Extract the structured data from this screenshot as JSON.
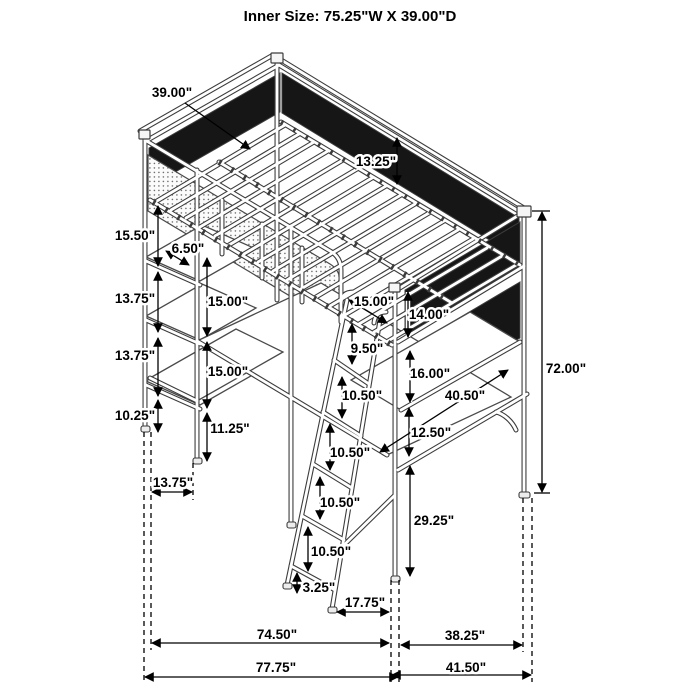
{
  "title": "Inner Size: 75.25\"W X 39.00\"D",
  "diagram_type": "isometric loft-bed dimension drawing",
  "colors": {
    "line": "#3c3c3c",
    "mesh": "#161616",
    "dimension": "#000000",
    "background": "#ffffff"
  },
  "dims": [
    {
      "id": "top-depth",
      "label": "39.00\""
    },
    {
      "id": "guard-rail-height",
      "label": "13.25\""
    },
    {
      "id": "shelf-gap-1",
      "label": "15.50\""
    },
    {
      "id": "shelf-setback",
      "label": "6.50\""
    },
    {
      "id": "shelf-gap-2",
      "label": "13.75\""
    },
    {
      "id": "desk-clearance-upper",
      "label": "15.00\""
    },
    {
      "id": "ladder-opening",
      "label": "15.00\""
    },
    {
      "id": "right-panel-upper",
      "label": "14.00\""
    },
    {
      "id": "shelf-gap-3",
      "label": "13.75\""
    },
    {
      "id": "desk-clearance-lower",
      "label": "15.00\""
    },
    {
      "id": "ladder-top-gap",
      "label": "9.50\""
    },
    {
      "id": "right-panel-lower",
      "label": "16.00\""
    },
    {
      "id": "shelf-gap-4",
      "label": "10.25\""
    },
    {
      "id": "desk-leg-height",
      "label": "11.25\""
    },
    {
      "id": "ladder-rung-gap-1",
      "label": "10.50\""
    },
    {
      "id": "lower-desk-width",
      "label": "40.50\""
    },
    {
      "id": "lower-desk-gap",
      "label": "12.50\""
    },
    {
      "id": "total-height",
      "label": "72.00\""
    },
    {
      "id": "shelf-width",
      "label": "13.75\""
    },
    {
      "id": "ladder-rung-gap-2",
      "label": "10.50\""
    },
    {
      "id": "ladder-rung-gap-3",
      "label": "10.50\""
    },
    {
      "id": "ladder-rung-gap-4",
      "label": "10.50\""
    },
    {
      "id": "lower-rail-height",
      "label": "29.25\""
    },
    {
      "id": "ladder-foot-height",
      "label": "3.25\""
    },
    {
      "id": "ladder-foot-offset",
      "label": "17.75\""
    },
    {
      "id": "inner-width-floor",
      "label": "74.50\""
    },
    {
      "id": "right-inner-depth",
      "label": "38.25\""
    },
    {
      "id": "outer-width-floor",
      "label": "77.75\""
    },
    {
      "id": "right-outer-depth",
      "label": "41.50\""
    }
  ]
}
